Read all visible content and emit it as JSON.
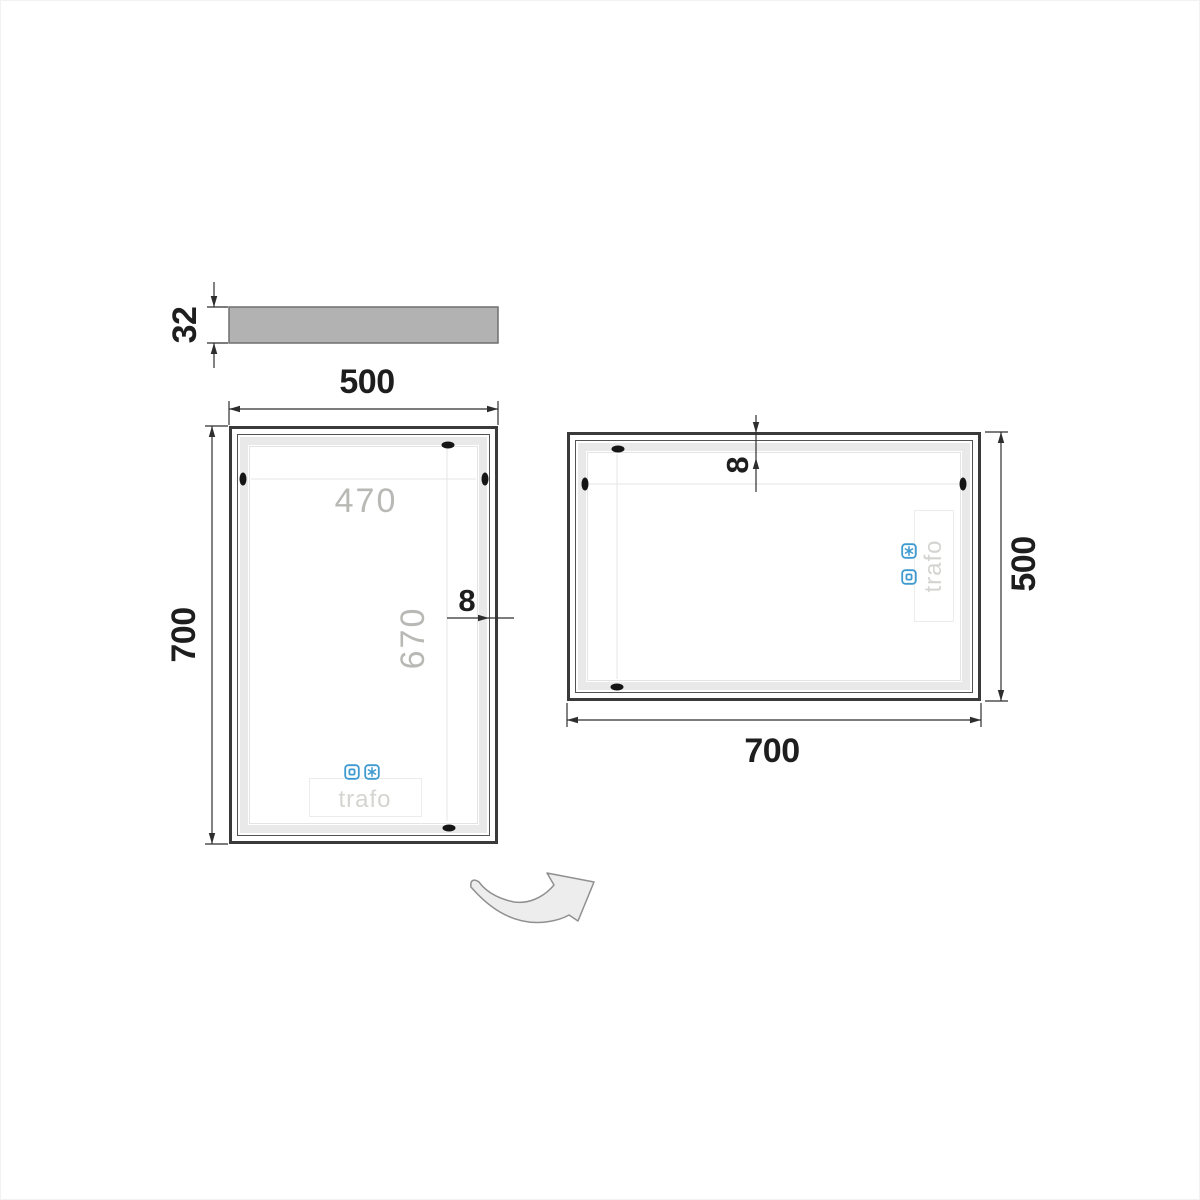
{
  "drawing_title": "LED mirror dimension drawing",
  "colors": {
    "accent_blue": "#3f9ad0",
    "dimension_text": "#1e1e1e",
    "inner_dimension_text": "#b8b8b4",
    "trafo_text": "#d4d4d1",
    "frame": "#3a3a3a",
    "led_band": "#e9e9e9",
    "profile_fill": "#b2b2b2"
  },
  "profile_view": {
    "thickness_label": "32"
  },
  "front_view": {
    "width_label": "500",
    "height_label": "700",
    "inner_width_label": "470",
    "inner_height_label": "670",
    "band_label": "8",
    "trafo_label": "trafo"
  },
  "rotated_view": {
    "band_label": "8",
    "height_label": "500",
    "width_label": "700",
    "trafo_label": "trafo"
  },
  "icons": {
    "touch_sensor": "touch-sensor-icon",
    "defogger": "defogger-icon",
    "rotation": "rotation-arrow"
  }
}
